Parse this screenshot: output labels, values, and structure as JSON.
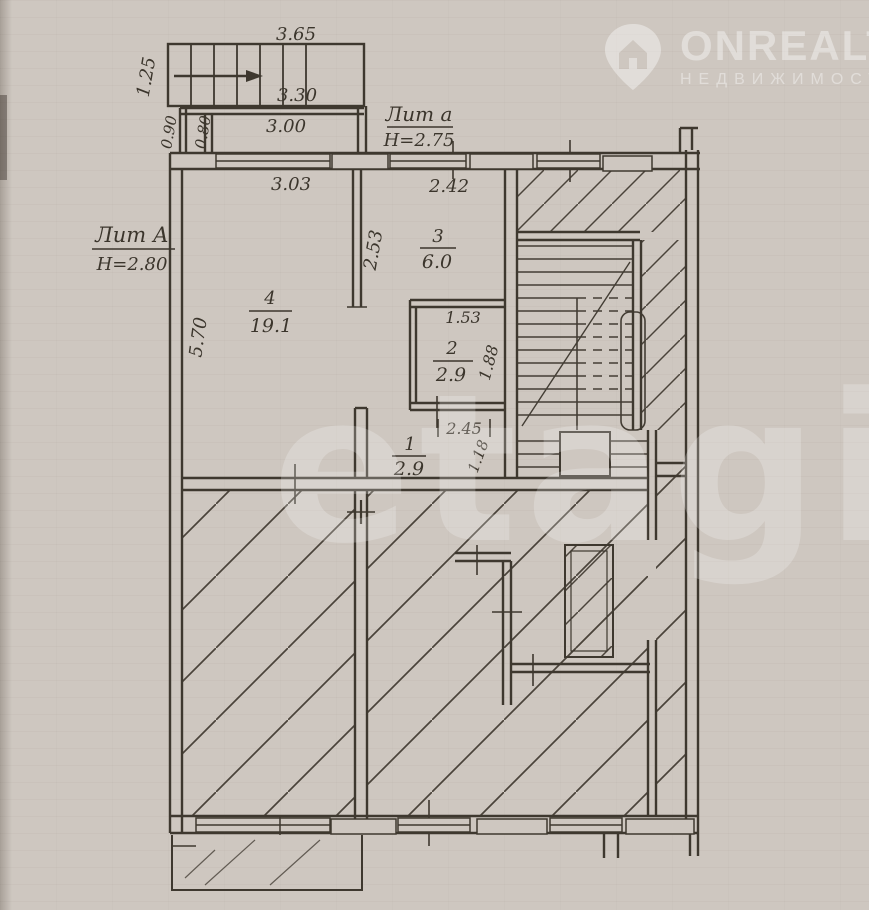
{
  "watermark": {
    "brand": "ONREALT",
    "brand_sub": "НЕДВИЖИМОСТЬ",
    "center": "etagi",
    "icon": "house-pin-icon"
  },
  "plan": {
    "litera_main": {
      "label": "Лит А",
      "height": "Н=2.80"
    },
    "litera_annex": {
      "label": "Лит а",
      "height": "Н=2.75"
    },
    "rooms": {
      "room4": {
        "num": "4",
        "area": "19.1"
      },
      "room3": {
        "num": "3",
        "area": "6.0"
      },
      "room2": {
        "num": "2",
        "area": "2.9"
      },
      "room1": {
        "num": "1",
        "area": "2.9"
      }
    },
    "dims": {
      "porch_width": "3.65",
      "porch_depth": "1.25",
      "annex_width": "3.30",
      "annex_inner_width": "3.00",
      "annex_left_outer": "0.90",
      "annex_left_inner": "0.80",
      "room4_window": "3.03",
      "room4_depth": "5.70",
      "room3_window": "2.42",
      "room3_depth": "2.53",
      "closet_width": "1.53",
      "closet_depth": "1.88",
      "hall_width": "2.45",
      "hall_depth": "1.18"
    },
    "colors": {
      "ink": "#3e382f",
      "paper": "#cec7c0"
    }
  }
}
